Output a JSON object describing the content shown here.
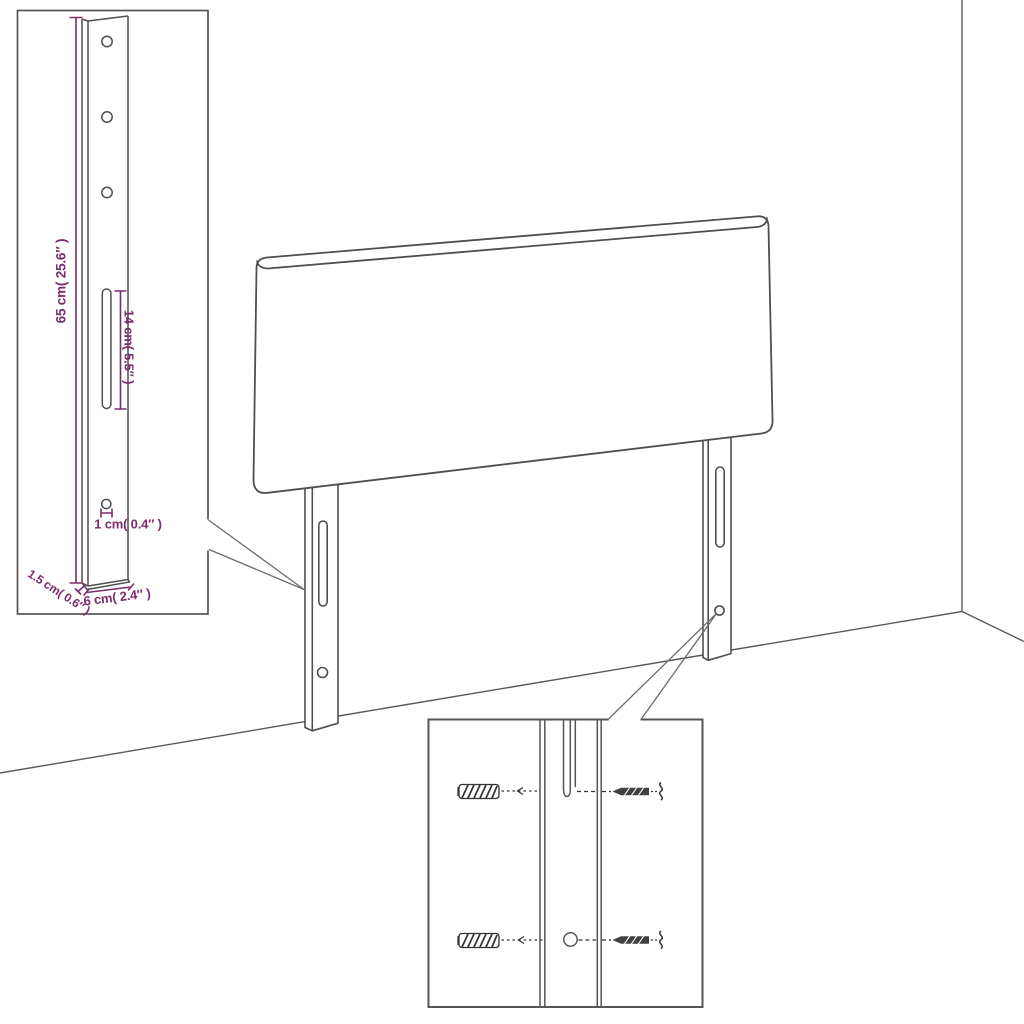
{
  "diagram_labels": {
    "bracket_height": "65 cm( 25.6″ )",
    "slot_length": "14 cm( 5.5″ )",
    "hole_diameter": "1 cm( 0.4″ )",
    "bracket_depth": "1.5 cm( 0.6″ )",
    "bracket_width": "6 cm( 2.4″ )"
  },
  "colors": {
    "dimension_accent": "#7b2c6e",
    "line_art": "#4f4f4f"
  }
}
